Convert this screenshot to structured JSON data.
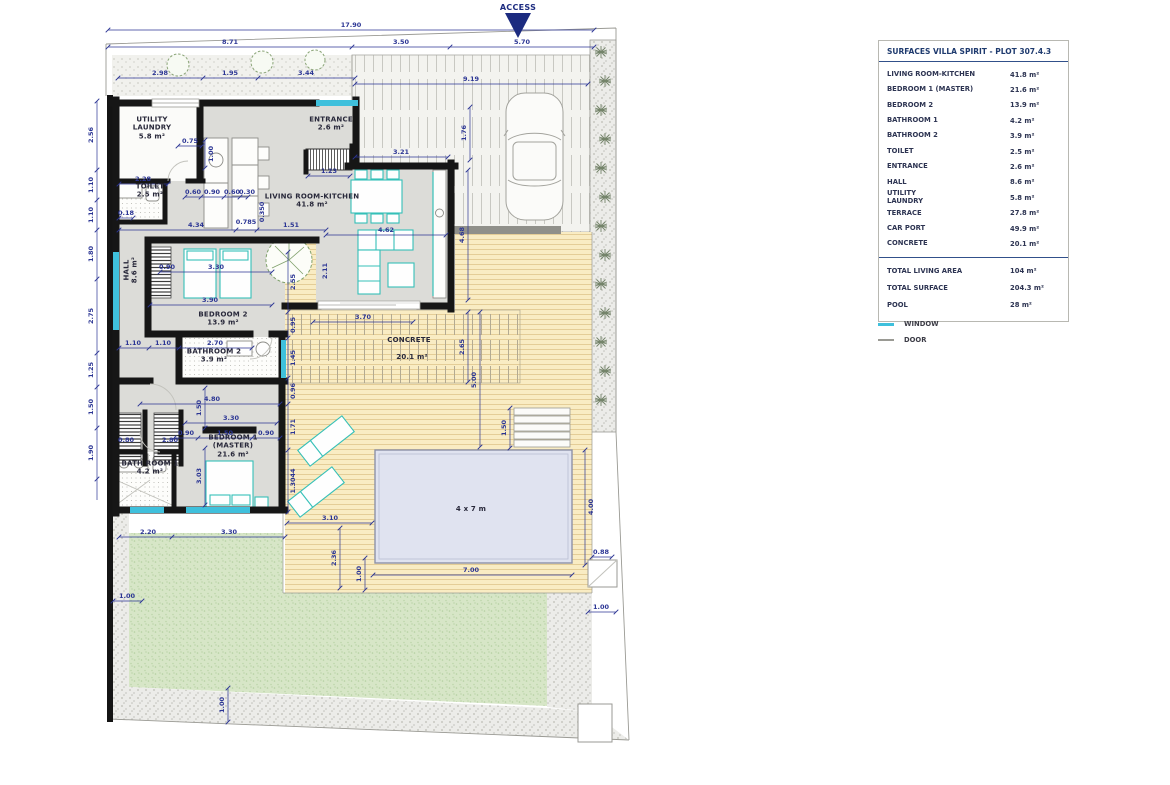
{
  "panel": {
    "title": "SURFACES VILLA SPIRIT - PLOT 307.4.3",
    "rows": [
      {
        "label": "LIVING ROOM-KITCHEN",
        "value": "41.8 m²"
      },
      {
        "label": "BEDROOM 1 (MASTER)",
        "value": "21.6 m²"
      },
      {
        "label": "BEDROOM 2",
        "value": "13.9 m²"
      },
      {
        "label": "BATHROOM 1",
        "value": "4.2 m²"
      },
      {
        "label": "BATHROOM 2",
        "value": "3.9 m²"
      },
      {
        "label": "TOILET",
        "value": "2.5 m²"
      },
      {
        "label": "ENTRANCE",
        "value": "2.6 m²"
      },
      {
        "label": "HALL",
        "value": "8.6 m²"
      },
      {
        "label": "UTILITY\nLAUNDRY",
        "value": "5.8 m²"
      },
      {
        "label": "TERRACE",
        "value": "27.8 m²"
      },
      {
        "label": "CAR PORT",
        "value": "49.9 m²"
      },
      {
        "label": "CONCRETE",
        "value": "20.1 m²"
      }
    ],
    "totals": [
      {
        "label": "TOTAL LIVING AREA",
        "value": "104 m²"
      },
      {
        "label": "TOTAL SURFACE",
        "value": "204.3 m²"
      },
      {
        "label": "POOL",
        "value": "28 m²"
      }
    ],
    "legend": [
      {
        "label": "WINDOW",
        "color": "#3fc0dc"
      },
      {
        "label": "DOOR",
        "color": "#9a9a94"
      }
    ]
  },
  "plan": {
    "access_label": "ACCESS",
    "room_labels": [
      {
        "lines": [
          "UTILITY",
          "LAUNDRY",
          "5.8 m²"
        ],
        "x": 152,
        "y": 128
      },
      {
        "lines": [
          "TOILET",
          "2.5 m²"
        ],
        "x": 150,
        "y": 191
      },
      {
        "lines": [
          "ENTRANCE",
          "2.6 m²"
        ],
        "x": 331,
        "y": 124
      },
      {
        "lines": [
          "LIVING ROOM-KITCHEN",
          "41.8 m²"
        ],
        "x": 312,
        "y": 201
      },
      {
        "lines": [
          "HALL",
          "8.6 m²"
        ],
        "x": 131,
        "y": 270,
        "rot": true
      },
      {
        "lines": [
          "BEDROOM 2",
          "13.9 m²"
        ],
        "x": 223,
        "y": 319
      },
      {
        "lines": [
          "BATHROOM 2",
          "3.9 m²"
        ],
        "x": 214,
        "y": 356
      },
      {
        "lines": [
          "BEDROOM 1",
          "(MASTER)",
          "21.6 m²"
        ],
        "x": 233,
        "y": 446
      },
      {
        "lines": [
          "BATH ROOM 1",
          "4.2 m²"
        ],
        "x": 150,
        "y": 468
      },
      {
        "lines": [
          "CONCRETE"
        ],
        "x": 409,
        "y": 340
      },
      {
        "lines": [
          "20.1 m²"
        ],
        "x": 412,
        "y": 357
      },
      {
        "lines": [
          "4 x 7 m"
        ],
        "x": 471,
        "y": 509
      }
    ],
    "dim_labels": [
      {
        "t": "17.90",
        "x": 351,
        "y": 25
      },
      {
        "t": "8.71",
        "x": 230,
        "y": 42
      },
      {
        "t": "3.50",
        "x": 401,
        "y": 42
      },
      {
        "t": "5.70",
        "x": 522,
        "y": 42
      },
      {
        "t": "2.98",
        "x": 160,
        "y": 73
      },
      {
        "t": "1.95",
        "x": 230,
        "y": 73
      },
      {
        "t": "3.44",
        "x": 306,
        "y": 73
      },
      {
        "t": "9.19",
        "x": 471,
        "y": 79
      },
      {
        "t": "1.76",
        "x": 464,
        "y": 133,
        "r": 1
      },
      {
        "t": "3.21",
        "x": 401,
        "y": 152
      },
      {
        "t": "1.23",
        "x": 329,
        "y": 171
      },
      {
        "t": "0.75",
        "x": 190,
        "y": 141
      },
      {
        "t": "1.00",
        "x": 211,
        "y": 154,
        "r": 1
      },
      {
        "t": "2.28",
        "x": 143,
        "y": 179
      },
      {
        "t": "0.60",
        "x": 193,
        "y": 192
      },
      {
        "t": "0.90",
        "x": 212,
        "y": 192
      },
      {
        "t": "0.60",
        "x": 232,
        "y": 192
      },
      {
        "t": "0.30",
        "x": 247,
        "y": 192
      },
      {
        "t": "0.18",
        "x": 126,
        "y": 213
      },
      {
        "t": "4.34",
        "x": 196,
        "y": 225
      },
      {
        "t": "0.785",
        "x": 246,
        "y": 222
      },
      {
        "t": "0.350",
        "x": 262,
        "y": 212,
        "r": 1
      },
      {
        "t": "1.51",
        "x": 291,
        "y": 225
      },
      {
        "t": "4.62",
        "x": 386,
        "y": 230
      },
      {
        "t": "2.11",
        "x": 325,
        "y": 271,
        "r": 1
      },
      {
        "t": "4.68",
        "x": 462,
        "y": 235,
        "r": 1
      },
      {
        "t": "0.90",
        "x": 167,
        "y": 267
      },
      {
        "t": "3.30",
        "x": 216,
        "y": 267
      },
      {
        "t": "3.90",
        "x": 210,
        "y": 300
      },
      {
        "t": "1.10",
        "x": 133,
        "y": 343
      },
      {
        "t": "1.10",
        "x": 163,
        "y": 343
      },
      {
        "t": "2.70",
        "x": 215,
        "y": 343
      },
      {
        "t": "2.55",
        "x": 293,
        "y": 282,
        "r": 1
      },
      {
        "t": "0.95",
        "x": 293,
        "y": 325,
        "r": 1
      },
      {
        "t": "1.45",
        "x": 293,
        "y": 358,
        "r": 1
      },
      {
        "t": "0.96",
        "x": 293,
        "y": 391,
        "r": 1
      },
      {
        "t": "1.71",
        "x": 293,
        "y": 427,
        "r": 1
      },
      {
        "t": "1.3044",
        "x": 293,
        "y": 481,
        "r": 1
      },
      {
        "t": "3.70",
        "x": 363,
        "y": 317
      },
      {
        "t": "2.65",
        "x": 462,
        "y": 347,
        "r": 1
      },
      {
        "t": "5.00",
        "x": 474,
        "y": 380,
        "r": 1
      },
      {
        "t": "4.80",
        "x": 212,
        "y": 399
      },
      {
        "t": "1.50",
        "x": 199,
        "y": 408,
        "r": 1
      },
      {
        "t": "3.30",
        "x": 231,
        "y": 418
      },
      {
        "t": "0.90",
        "x": 186,
        "y": 433
      },
      {
        "t": "1.50",
        "x": 225,
        "y": 433
      },
      {
        "t": "0.90",
        "x": 266,
        "y": 433
      },
      {
        "t": "3.03",
        "x": 199,
        "y": 476,
        "r": 1
      },
      {
        "t": "0.80",
        "x": 126,
        "y": 440
      },
      {
        "t": "2.80",
        "x": 170,
        "y": 440
      },
      {
        "t": "1.50",
        "x": 504,
        "y": 428,
        "r": 1
      },
      {
        "t": "3.10",
        "x": 330,
        "y": 518
      },
      {
        "t": "2.36",
        "x": 334,
        "y": 558,
        "r": 1
      },
      {
        "t": "1.00",
        "x": 359,
        "y": 574,
        "r": 1
      },
      {
        "t": "7.00",
        "x": 471,
        "y": 570
      },
      {
        "t": "4.00",
        "x": 591,
        "y": 507,
        "r": 1
      },
      {
        "t": "0.88",
        "x": 601,
        "y": 552
      },
      {
        "t": "2.20",
        "x": 148,
        "y": 532
      },
      {
        "t": "3.30",
        "x": 229,
        "y": 532
      },
      {
        "t": "1.00",
        "x": 127,
        "y": 596
      },
      {
        "t": "1.00",
        "x": 601,
        "y": 607
      },
      {
        "t": "1.00",
        "x": 222,
        "y": 705,
        "r": 1
      },
      {
        "t": "2.56",
        "x": 91,
        "y": 135,
        "r": 1
      },
      {
        "t": "1.10",
        "x": 91,
        "y": 185,
        "r": 1
      },
      {
        "t": "1.10",
        "x": 91,
        "y": 215,
        "r": 1
      },
      {
        "t": "1.80",
        "x": 91,
        "y": 254,
        "r": 1
      },
      {
        "t": "2.75",
        "x": 91,
        "y": 316,
        "r": 1
      },
      {
        "t": "1.25",
        "x": 91,
        "y": 370,
        "r": 1
      },
      {
        "t": "1.50",
        "x": 91,
        "y": 407,
        "r": 1
      },
      {
        "t": "1.90",
        "x": 91,
        "y": 453,
        "r": 1
      }
    ]
  },
  "colors": {
    "dimension": "#2b3594",
    "wall": "#161616",
    "window": "#3fc0dc",
    "door": "#9a9a94",
    "furniture": "#35c0b8",
    "deck": "#f9ecc3",
    "grass": "#d7e6c7",
    "pool": "#e0e3f0",
    "access": "#1c2b80",
    "title": "#1e3a6e"
  }
}
